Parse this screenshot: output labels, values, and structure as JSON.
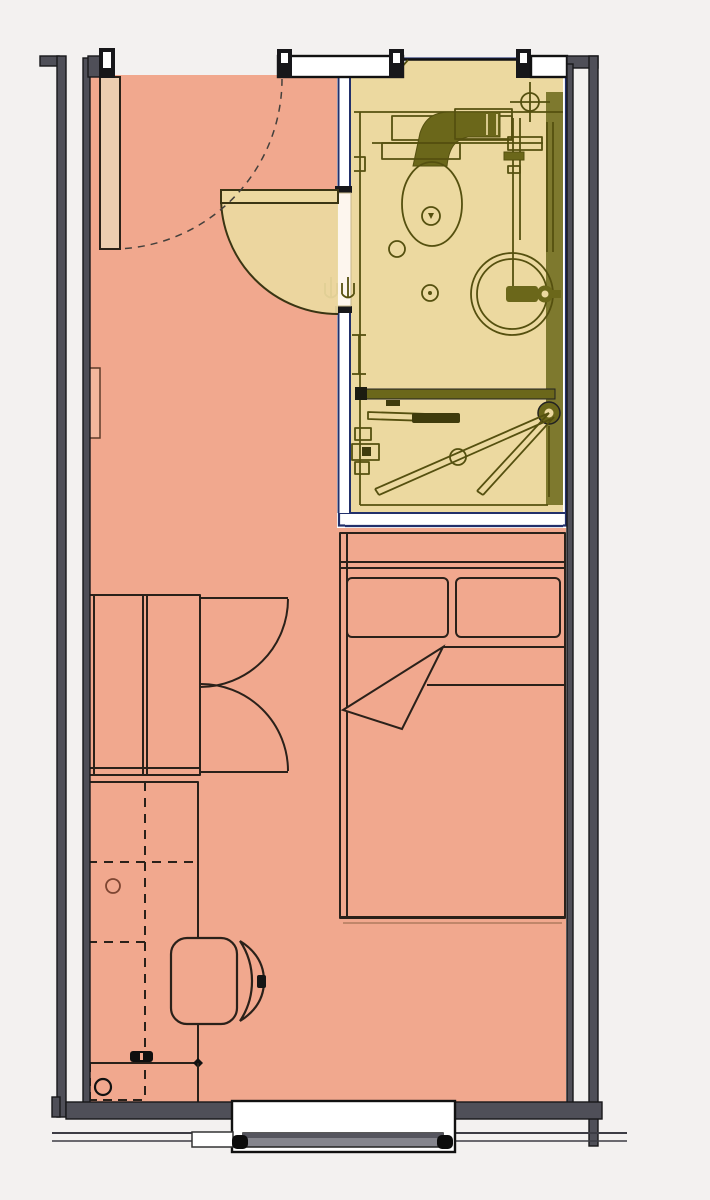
{
  "diagram": {
    "type": "architectural-floor-plan",
    "description": "top-down plan of a studio room with prefabricated bathroom pod",
    "rooms": [
      {
        "id": "main-room",
        "label": "main room",
        "floor_color": "#f1a88e"
      },
      {
        "id": "bathroom-pod",
        "label": "bathroom pod",
        "floor_color": "#ecd9a0"
      }
    ],
    "fixtures": [
      {
        "id": "entry-door",
        "label": "entry door with dashed swing arc",
        "room": "main-room"
      },
      {
        "id": "bathroom-door",
        "label": "bathroom pod door with quarter-circle swing",
        "room": "bathroom-pod"
      },
      {
        "id": "toilet",
        "label": "wall-hung toilet with duct connection",
        "room": "bathroom-pod"
      },
      {
        "id": "washbasin",
        "label": "round washbasin with faucet",
        "room": "bathroom-pod"
      },
      {
        "id": "shower-enclosure",
        "label": "shower with pivoting folding screen",
        "room": "bathroom-pod"
      },
      {
        "id": "floor-drains",
        "label": "floor drains",
        "room": "bathroom-pod"
      },
      {
        "id": "plumbing-risers",
        "label": "vertical pipe risers",
        "room": "bathroom-pod"
      },
      {
        "id": "vent-symbol",
        "label": "crosshair vent/stack symbol",
        "room": "bathroom-pod"
      },
      {
        "id": "bed",
        "label": "double bed with two pillows and folded blanket",
        "room": "main-room"
      },
      {
        "id": "wardrobe",
        "label": "double-door wardrobe with swing arcs",
        "room": "main-room"
      },
      {
        "id": "desk",
        "label": "desk counter with dashed overhead shelving",
        "room": "main-room"
      },
      {
        "id": "office-chair",
        "label": "office chair",
        "room": "main-room"
      },
      {
        "id": "radiator",
        "label": "wall radiator panel",
        "room": "main-room"
      },
      {
        "id": "window",
        "label": "window in bottom exterior wall",
        "room": "main-room"
      }
    ],
    "pillow_count": 2,
    "wardrobe_door_count": 2
  },
  "colors": {
    "bg": "#f3f1f0",
    "floor": "#f1a88e",
    "floor_edge": "#c98a6e",
    "bath": "#ecd9a0",
    "bath_line": "#55500f",
    "bath_dark": "#6b671a",
    "pod_outline": "#22306b",
    "wall": "#4f4f58",
    "wall_dark": "#17171a",
    "furn_line": "#2a211a",
    "door": "#eccdb0",
    "window_bar": "#85858d",
    "exterior_line": "#3c3c44"
  }
}
